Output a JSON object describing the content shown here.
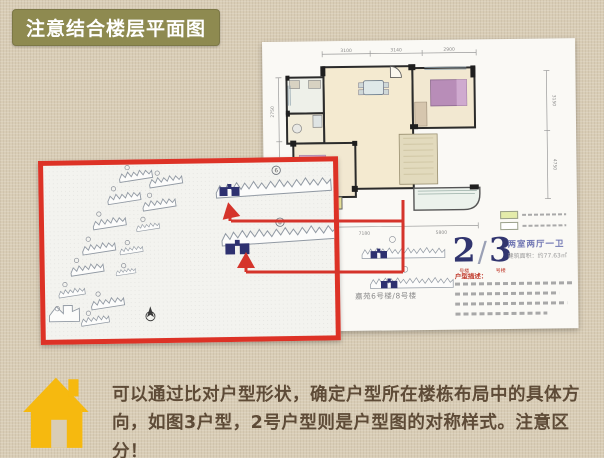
{
  "header": {
    "title": "注意结合楼层平面图"
  },
  "floorplan_sheet": {
    "unit_left": "2",
    "unit_divider": "/",
    "unit_right": "3",
    "unit_left_sub": "号楼",
    "unit_right_sub": "号楼",
    "layout_type": "两室两厅一卫",
    "area_text": "建筑面积：约77.63㎡",
    "desc_title": "户型描述：",
    "keyplan_label": "嘉苑6号楼/8号楼",
    "dims_top": [
      "3100",
      "3140",
      "2900"
    ],
    "dims_bottom": [
      "7180",
      "5800"
    ],
    "dims_left": [
      "2750",
      "2900"
    ],
    "dims_right": [
      "3150",
      "4750"
    ],
    "legend_swatch_colors": [
      "#e4ecaa",
      "#ffffff"
    ]
  },
  "siteplan": {
    "building_circle_labels": [
      "6",
      "8"
    ]
  },
  "footer": {
    "line1": "可以通过比对户型形状，确定户型所在楼栋布局中的具体方",
    "line2": "向，如图3户型，2号户型则是户型图的对称样式。注意区分！"
  },
  "colors": {
    "accent_red": "#dd3226",
    "banner_olive": "#8e8a50",
    "house_yellow": "#f6b90f",
    "navy_unit": "#2e3170",
    "text_brown": "#5e4b37",
    "background_tan": "#d9cdb6"
  }
}
